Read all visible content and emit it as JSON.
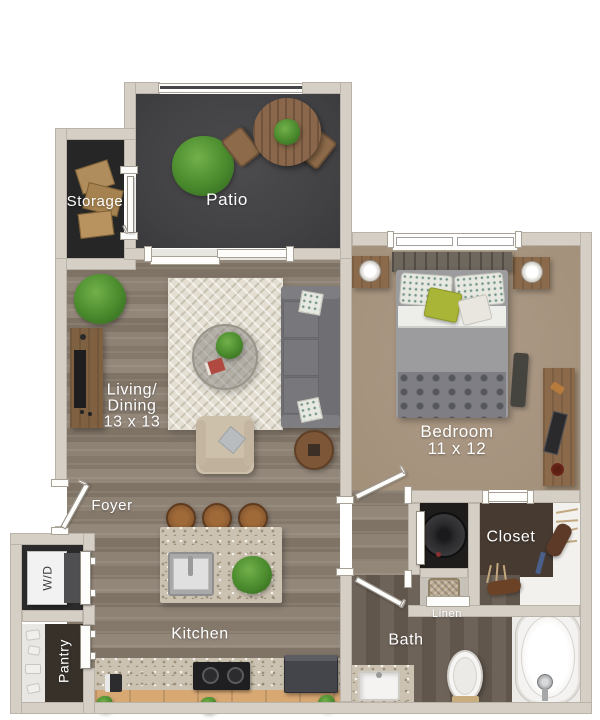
{
  "title": "One-bedroom apartment floor plan",
  "labels": {
    "storage": "Storage",
    "patio": "Patio",
    "living_line1": "Living/",
    "living_line2": "Dining",
    "living_line3": "13 x 13",
    "bedroom_line1": "Bedroom",
    "bedroom_line2": "11 x 12",
    "foyer": "Foyer",
    "kitchen": "Kitchen",
    "bath": "Bath",
    "closet": "Closet",
    "linen": "Linen",
    "wd": "W/D",
    "pantry": "Pantry"
  },
  "colors": {
    "wall": "#d5cfc6",
    "patio_floor": "#454548",
    "storage_floor": "#262626",
    "wood_floor": "#8c8073",
    "bedroom_floor": "#a89482",
    "bath_floor": "#675c52",
    "closet_rug": "#463a31",
    "granite": "#cbc2b1",
    "cabinet_wood": "#d8a873",
    "furniture_wood": "#8a6a4a",
    "sofa_gray": "#6f6f73",
    "accent_pillow_green": "#a9b537",
    "plant_green": "#4a8a2d",
    "fixture_white": "#f4f3f1",
    "label_text": "#ffffff"
  }
}
